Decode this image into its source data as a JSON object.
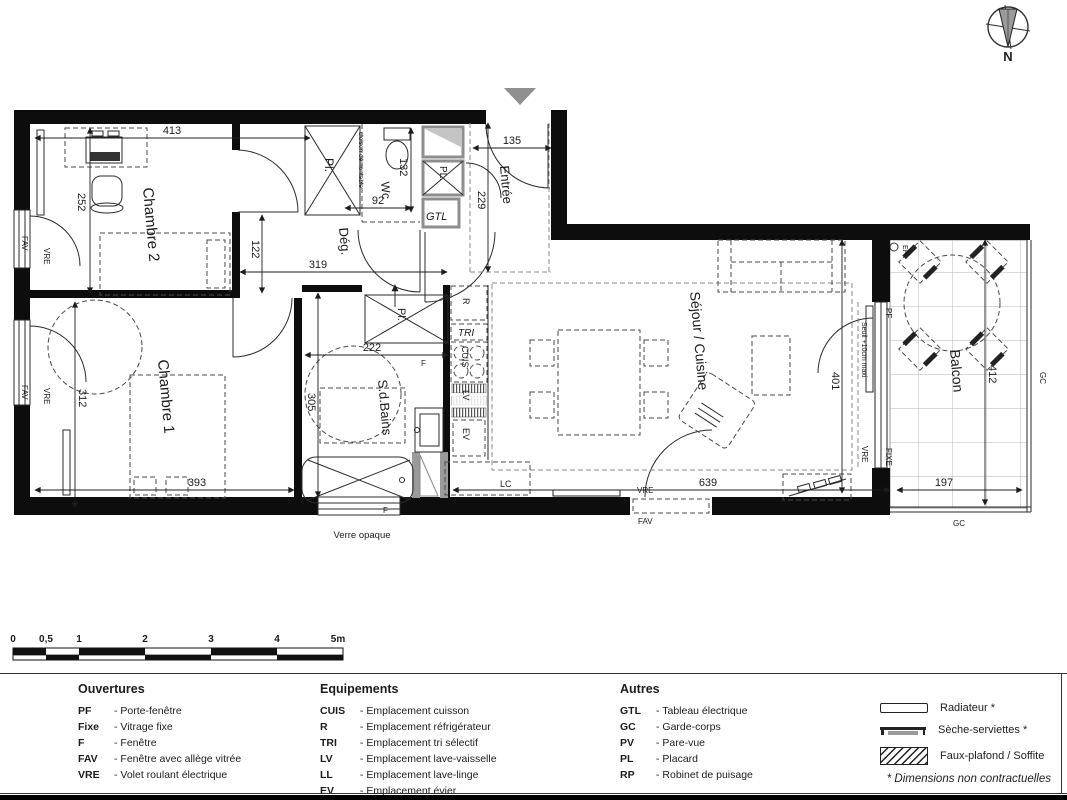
{
  "rooms": {
    "chambre2": "Chambre 2",
    "chambre1": "Chambre 1",
    "degagement": "Dég.",
    "wc": "Wc",
    "entree": "Entrée",
    "sdb": "S.d.Bains",
    "sejour": "Séjour / Cuisine",
    "balcon": "Balcon"
  },
  "closets": {
    "pl_top": "Pl.",
    "pl_bath": "Pl.",
    "pl_entry": "PL.",
    "gtl": "GTL"
  },
  "kitchen": {
    "r": "R",
    "tri": "TRI",
    "cuis": "CUIS",
    "lv": "LV",
    "ev": "EV",
    "lc": "LC"
  },
  "openings": {
    "pf": "PF",
    "fixe": "FIXE",
    "f": "F",
    "fav": "FAV",
    "vre": "VRE"
  },
  "notes": {
    "cloison": "cloison démontable",
    "seuil": "Seuil +10cm maxi",
    "verre": "Verre opaque",
    "ep": "EP",
    "gc": "GC",
    "north": "N"
  },
  "dims": {
    "d413": "413",
    "d252": "252",
    "d122": "122",
    "d319": "319",
    "d132": "132",
    "d92": "92",
    "d135": "135",
    "d229": "229",
    "d312": "312",
    "d393": "393",
    "d222": "222",
    "d305": "305",
    "d639": "639",
    "d401": "401",
    "d412": "412",
    "d197": "197"
  },
  "scalebar": {
    "labels": [
      "0",
      "0,5",
      "1",
      "2",
      "3",
      "4",
      "5m"
    ]
  },
  "legend": {
    "ouvertures": {
      "title": "Ouvertures",
      "items": [
        {
          "abbr": "PF",
          "label": "- Porte-fenêtre"
        },
        {
          "abbr": "Fixe",
          "label": "- Vitrage fixe"
        },
        {
          "abbr": "F",
          "label": "- Fenêtre"
        },
        {
          "abbr": "FAV",
          "label": "- Fenêtre avec allège vitrée"
        },
        {
          "abbr": "VRE",
          "label": "- Volet roulant électrique"
        }
      ]
    },
    "equipements": {
      "title": "Equipements",
      "items": [
        {
          "abbr": "CUIS",
          "label": "- Emplacement cuisson"
        },
        {
          "abbr": "R",
          "label": "- Emplacement réfrigérateur"
        },
        {
          "abbr": "TRI",
          "label": "- Emplacement tri sélectif"
        },
        {
          "abbr": "LV",
          "label": "- Emplacement lave-vaisselle"
        },
        {
          "abbr": "LL",
          "label": "- Emplacement lave-linge"
        },
        {
          "abbr": "EV",
          "label": "- Emplacement évier"
        },
        {
          "abbr": "LC",
          "label": "- Emplacement linéaire complémentaire"
        }
      ]
    },
    "autres": {
      "title": "Autres",
      "items": [
        {
          "abbr": "GTL",
          "label": "- Tableau électrique"
        },
        {
          "abbr": "GC",
          "label": "- Garde-corps"
        },
        {
          "abbr": "PV",
          "label": "- Pare-vue"
        },
        {
          "abbr": "PL",
          "label": "- Placard"
        },
        {
          "abbr": "RP",
          "label": "- Robinet de puisage"
        }
      ]
    },
    "symbols": {
      "items": [
        {
          "label": "Radiateur *"
        },
        {
          "label": "Sèche-serviettes *"
        },
        {
          "label": "Faux-plafond / Soffite"
        }
      ],
      "note": "* Dimensions non contractuelles"
    }
  }
}
